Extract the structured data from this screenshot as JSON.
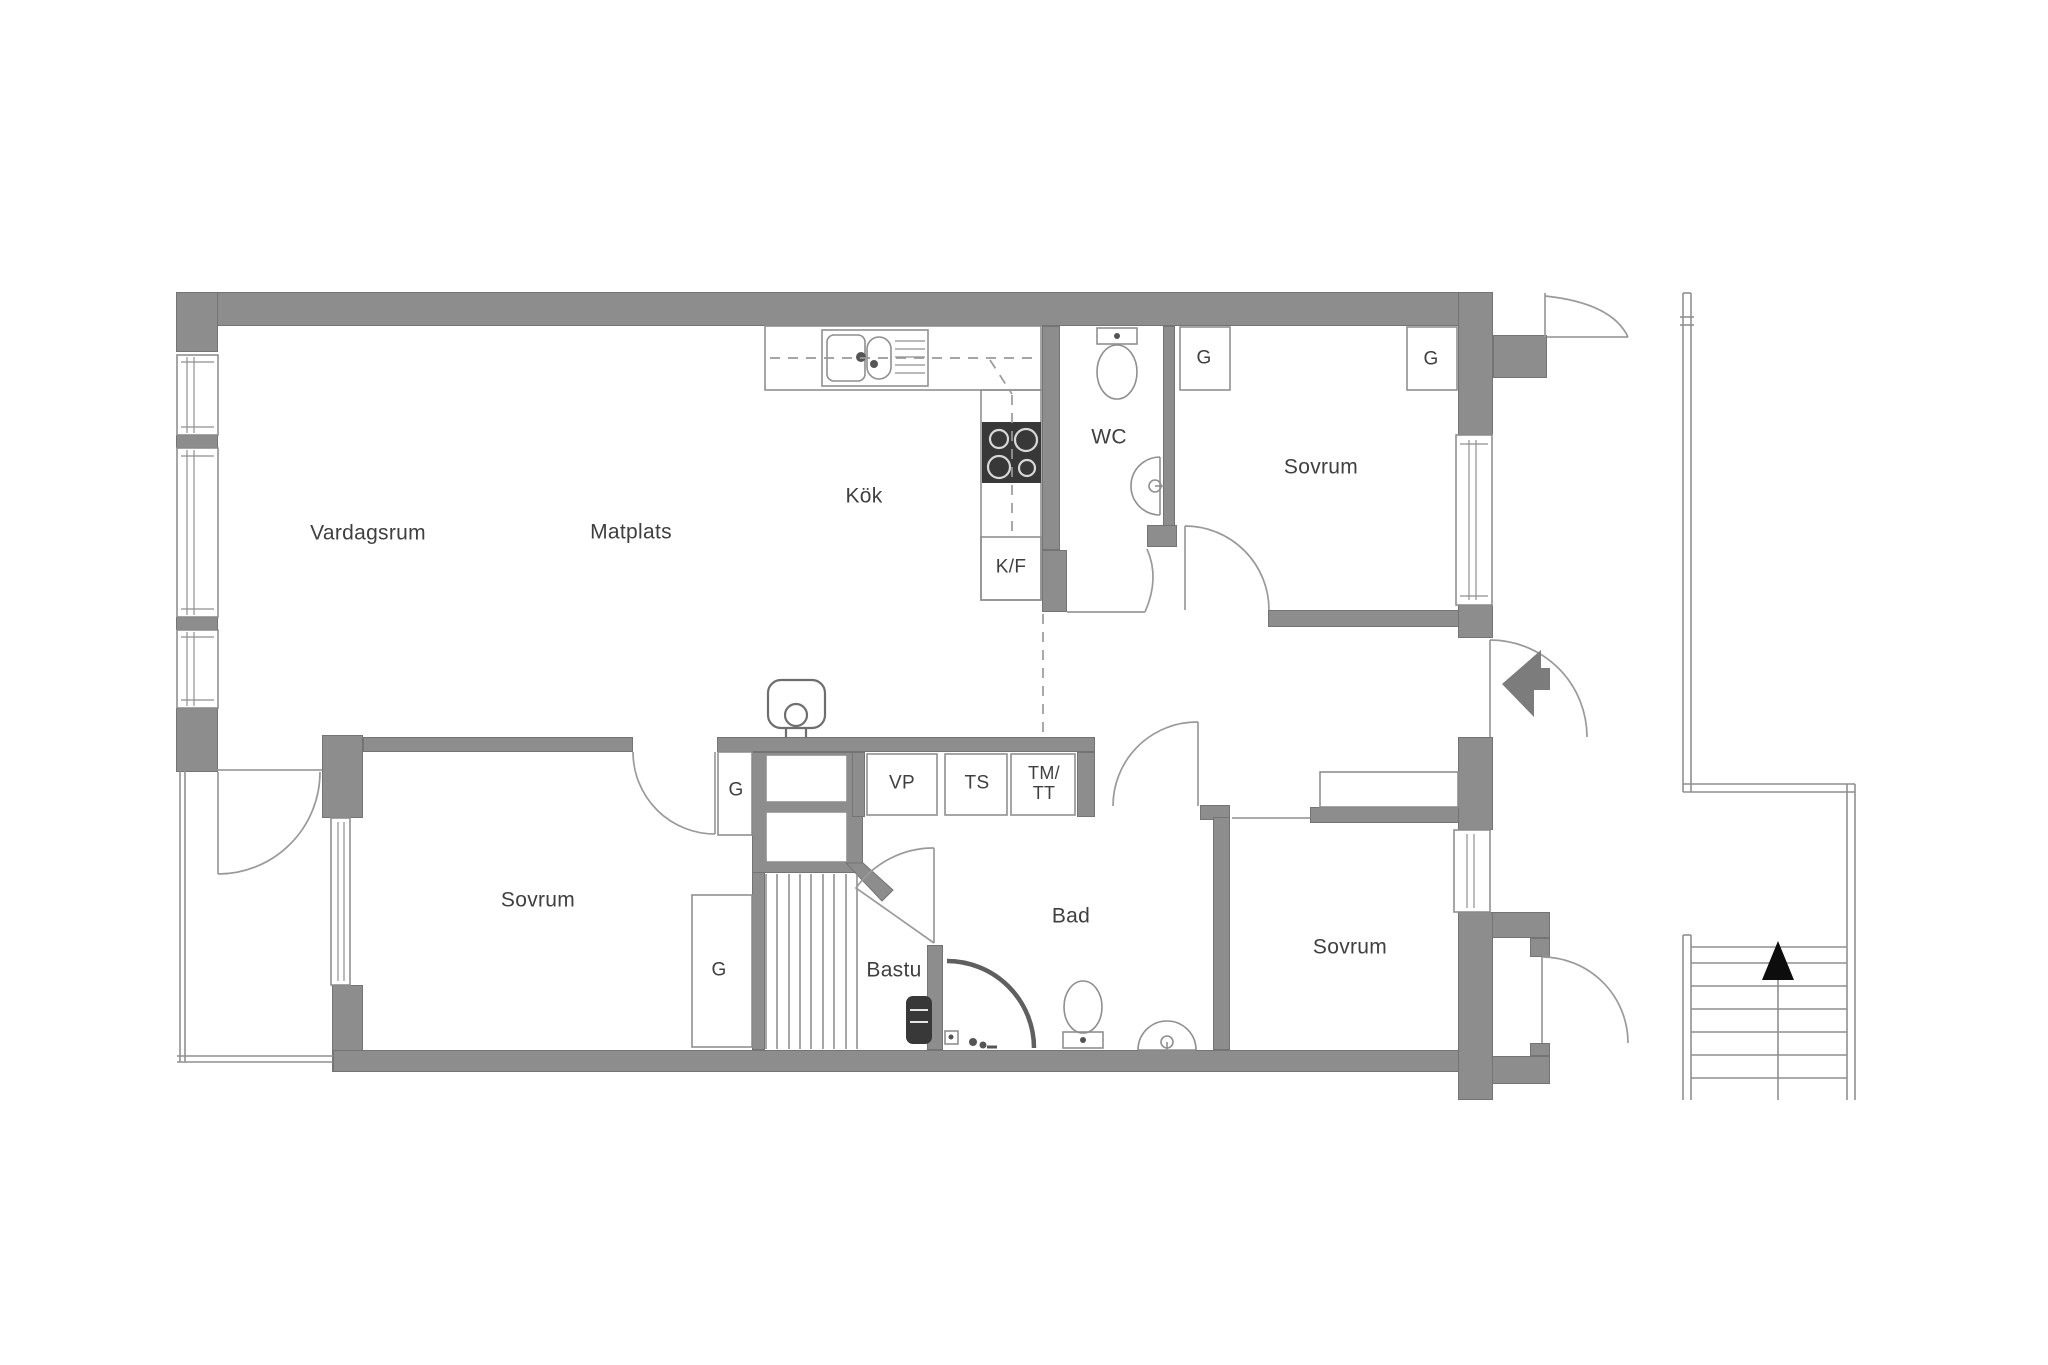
{
  "palette": {
    "background": "#ffffff",
    "wall": "#8d8d8d",
    "wall_dark": "#747474",
    "line": "#8f8f8f",
    "line_dark": "#6e6e6e",
    "text": "#3f3f3f",
    "appliance_dark": "#383838",
    "stair_arrow": "#0d0d0d"
  },
  "rooms": {
    "vardagsrum": "Vardagsrum",
    "matplats": "Matplats",
    "kok": "Kök",
    "wc": "WC",
    "sovrum_ne": "Sovrum",
    "sovrum_sw": "Sovrum",
    "sovrum_se": "Sovrum",
    "bad": "Bad",
    "bastu": "Bastu"
  },
  "closets": {
    "g": "G"
  },
  "appliances": {
    "kf": "K/F",
    "vp": "VP",
    "ts": "TS",
    "tm": "TM/",
    "tt": "TT"
  }
}
